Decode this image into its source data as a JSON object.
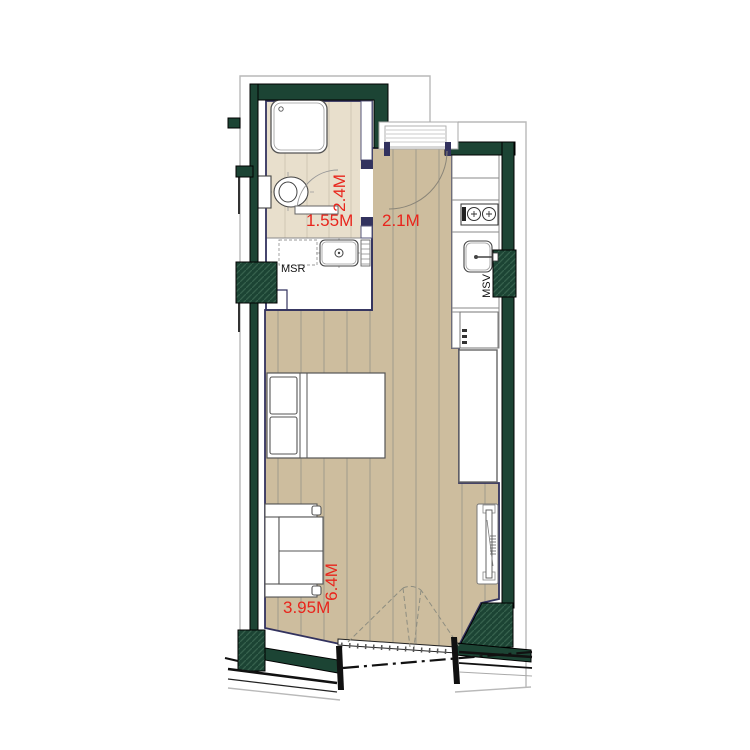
{
  "document": {
    "type": "studio-apartment-floor-plan"
  },
  "colors": {
    "wall_green": "#1c4434",
    "floor_tan": "#cdbd9e",
    "bathroom_floor": "#e8dfcc",
    "interior_line_navy": "#32325e",
    "dimension_text_red": "#e8251c",
    "outline_gray": "#b9b9b9",
    "fixture_line": "#555555"
  },
  "dimensions": {
    "bathroom_width": "1.55M",
    "bathroom_depth": "2.4M",
    "entry_width": "2.1M",
    "room_length": "6.4M",
    "room_width": "3.95M"
  },
  "labels": {
    "msr": "MSR",
    "msv": "MSV"
  }
}
